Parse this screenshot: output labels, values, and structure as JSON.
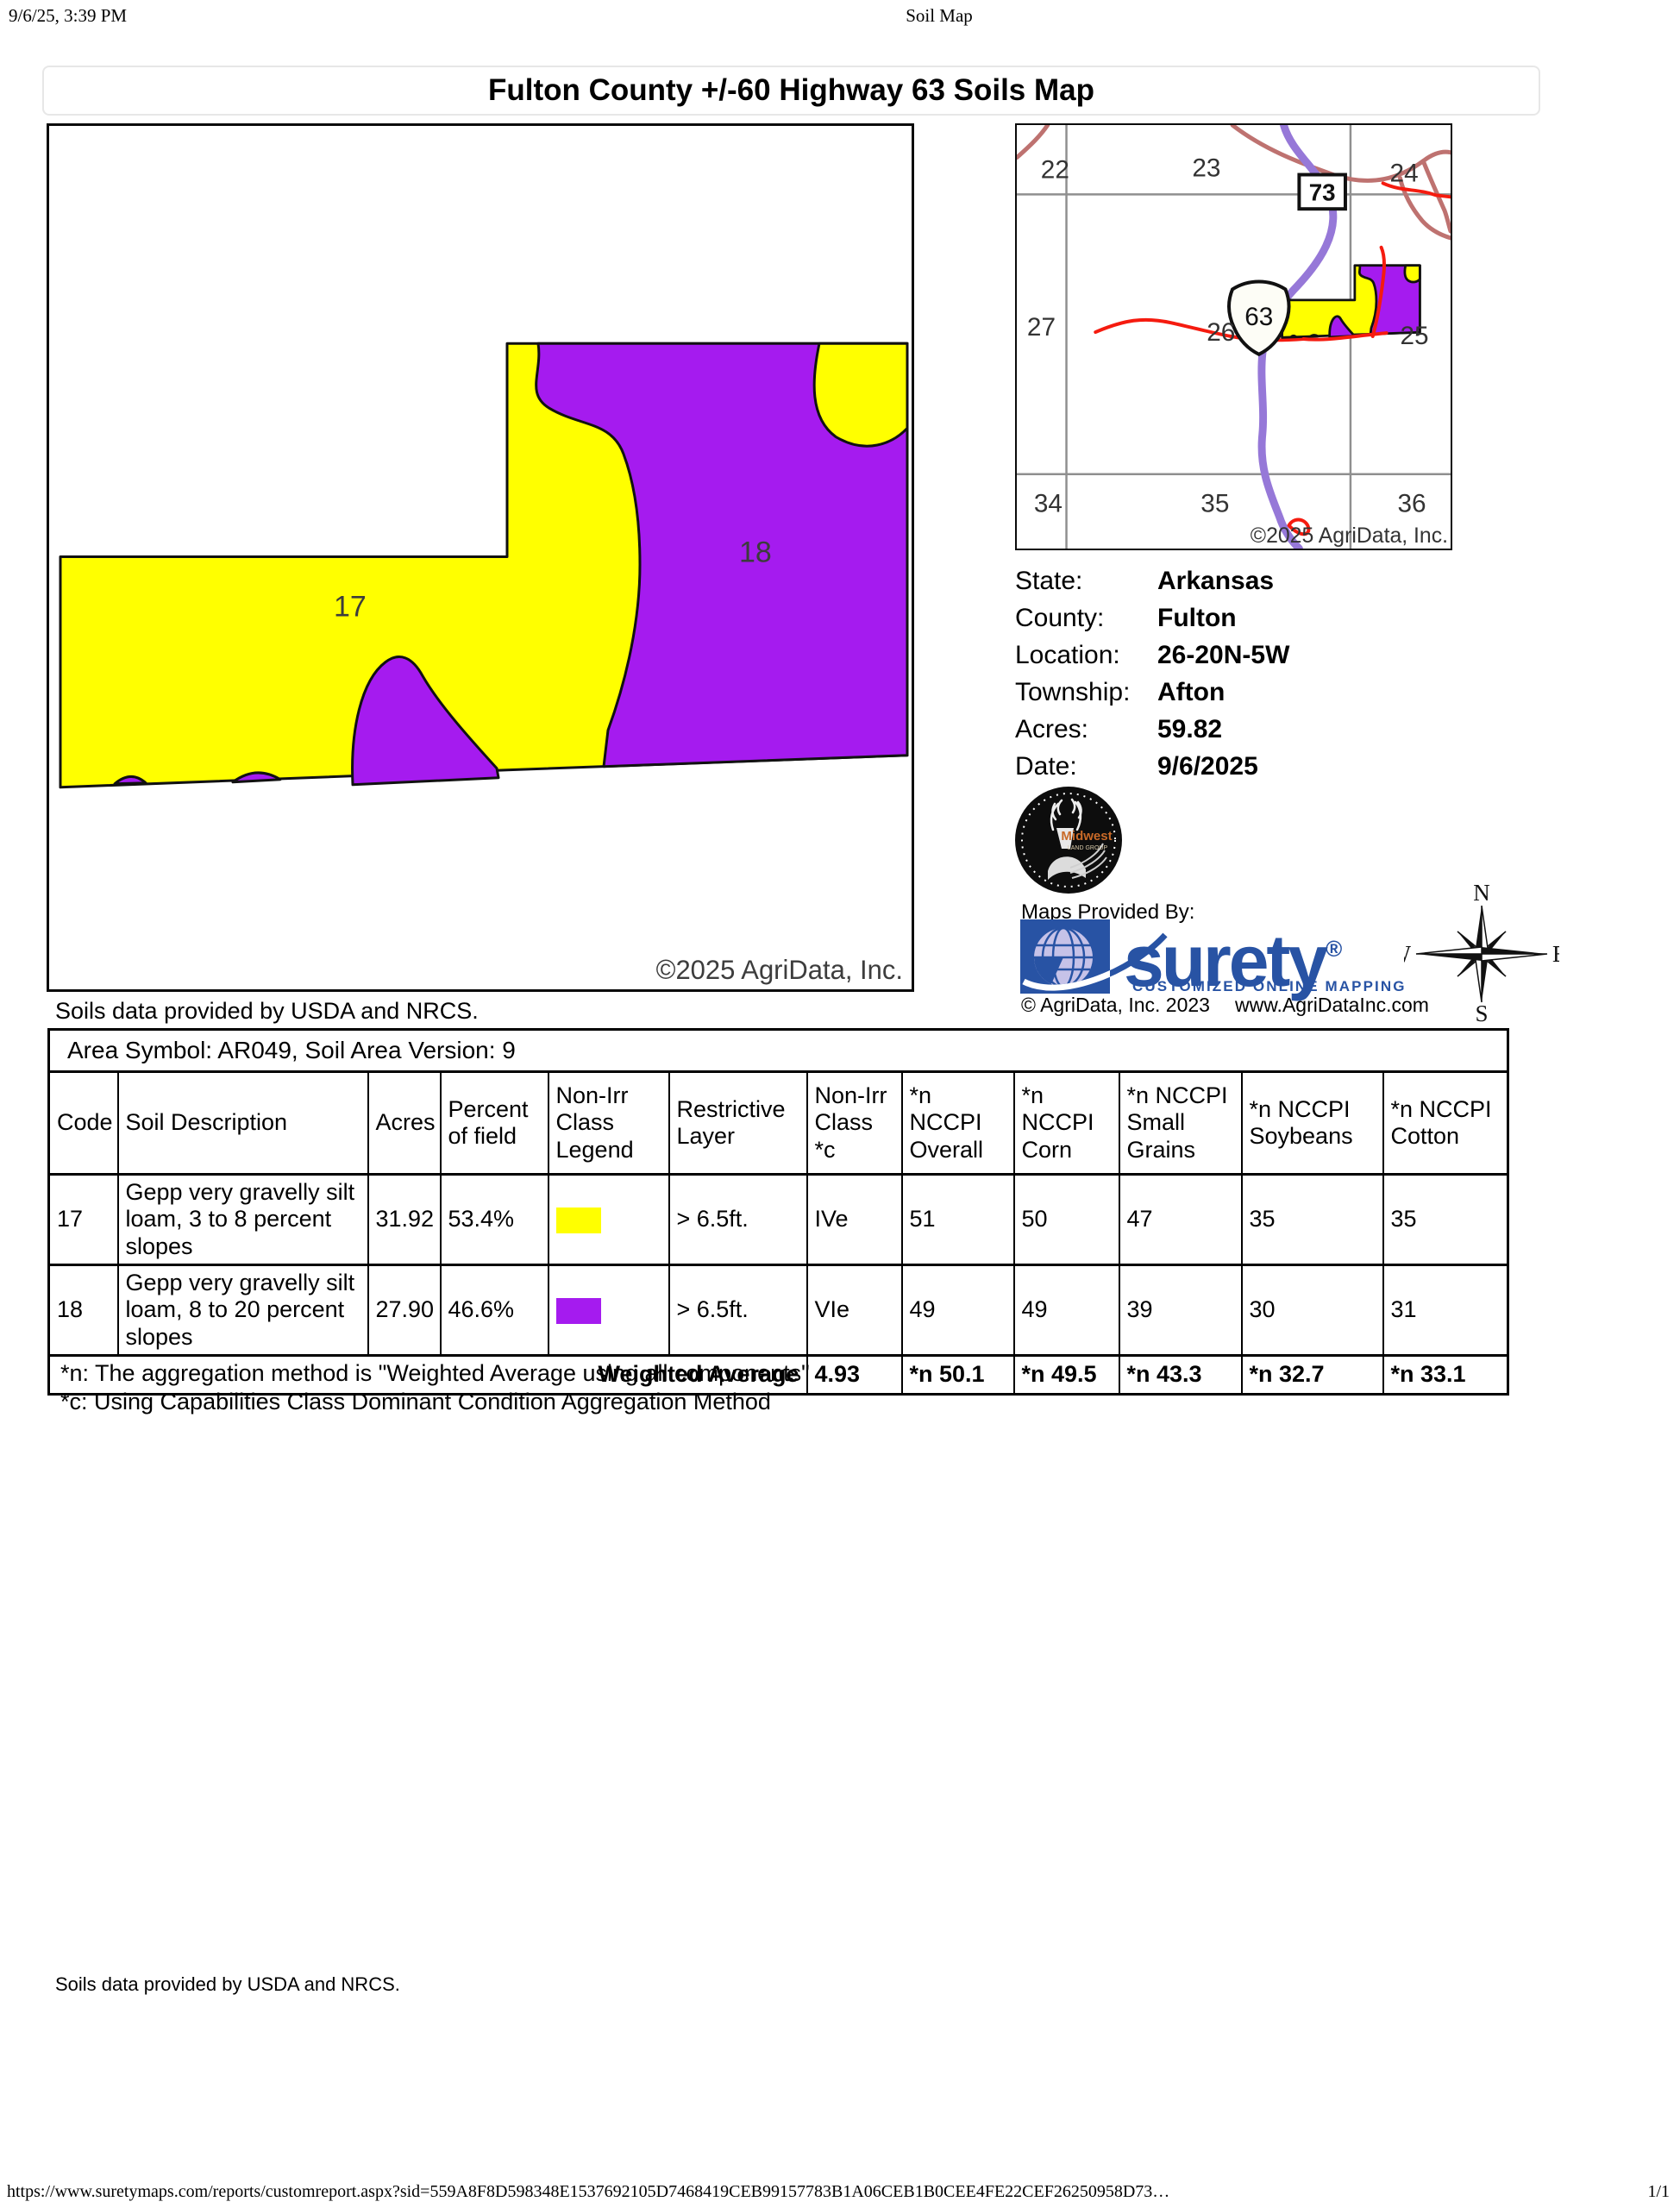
{
  "print_header": {
    "datetime": "9/6/25, 3:39 PM",
    "doc_title": "Soil Map"
  },
  "report": {
    "title": "Fulton County +/-60 Highway 63 Soils Map"
  },
  "main_map": {
    "label_17": "17",
    "label_18": "18",
    "copyright": "©2025 AgriData, Inc.",
    "soils_note": "Soils data provided by USDA and NRCS."
  },
  "inset_map": {
    "sections": [
      "22",
      "23",
      "24",
      "27",
      "26",
      "25",
      "34",
      "35",
      "36"
    ],
    "highway_badge": "73",
    "route_shield": "63",
    "copyright": "©2025 AgriData, Inc."
  },
  "location_info": {
    "rows": [
      {
        "label": "State:",
        "value": "Arkansas"
      },
      {
        "label": "County:",
        "value": "Fulton"
      },
      {
        "label": "Location:",
        "value": "26-20N-5W"
      },
      {
        "label": "Township:",
        "value": "Afton"
      },
      {
        "label": "Acres:",
        "value": "59.82"
      },
      {
        "label": "Date:",
        "value": "9/6/2025"
      }
    ]
  },
  "branding": {
    "maps_provided_by": "Maps Provided By:",
    "logo_word": "surety",
    "logo_reg": "®",
    "logo_tagline": "CUSTOMIZED ONLINE MAPPING",
    "copyright": "© AgriData, Inc. 2023",
    "website": "www.AgriDataInc.com",
    "midwest_name": "Midwest",
    "midwest_sub": "LAND GROUP",
    "compass": {
      "n": "N",
      "e": "E",
      "s": "S",
      "w": "W"
    }
  },
  "soil_table": {
    "area_symbol": "Area Symbol: AR049, Soil Area Version: 9",
    "headers": [
      "Code",
      "Soil Description",
      "Acres",
      "Percent of field",
      "Non-Irr Class Legend",
      "Restrictive Layer",
      "Non-Irr Class *c",
      "*n NCCPI Overall",
      "*n NCCPI Corn",
      "*n NCCPI Small Grains",
      "*n NCCPI Soybeans",
      "*n NCCPI Cotton"
    ],
    "rows": [
      {
        "code": "17",
        "description": "Gepp very gravelly silt loam, 3 to 8 percent slopes",
        "acres": "31.92",
        "percent": "53.4%",
        "legend_color": "soil_yellow",
        "restrictive_layer": "> 6.5ft.",
        "non_irr_class": "IVe",
        "nccpi_overall": "51",
        "nccpi_corn": "50",
        "nccpi_small_grains": "47",
        "nccpi_soybeans": "35",
        "nccpi_cotton": "35"
      },
      {
        "code": "18",
        "description": "Gepp very gravelly silt loam, 8 to 20 percent slopes",
        "acres": "27.90",
        "percent": "46.6%",
        "legend_color": "soil_purple",
        "restrictive_layer": "> 6.5ft.",
        "non_irr_class": "VIe",
        "nccpi_overall": "49",
        "nccpi_corn": "49",
        "nccpi_small_grains": "39",
        "nccpi_soybeans": "30",
        "nccpi_cotton": "31"
      }
    ],
    "weighted": {
      "label": "Weighted Average",
      "non_irr_class": "4.93",
      "nccpi_overall": "*n 50.1",
      "nccpi_corn": "*n 49.5",
      "nccpi_small_grains": "*n 43.3",
      "nccpi_soybeans": "*n 32.7",
      "nccpi_cotton": "*n 33.1"
    }
  },
  "footnotes": [
    "*n: The aggregation method is \"Weighted Average using all components\"",
    "*c: Using Capabilities Class Dominant Condition Aggregation Method"
  ],
  "bottom_note": "Soils data provided by USDA and NRCS.",
  "print_footer": {
    "url": "https://www.suretymaps.com/reports/customreport.aspx?sid=559A8F8D598348E1537692105D7468419CEB99157783B1A06CEB1B0CEE4FE22CEF26250958D73…",
    "page": "1/1"
  },
  "colors": {
    "soil_yellow": "#FFFF00",
    "soil_purple": "#A51BEF",
    "highway_purple": "#9678D8",
    "road_red": "#F51B0F",
    "road_brown": "#BE7270",
    "grid_gray": "#8f8f8f",
    "surety_blue": "#2853A4",
    "globe_lavender": "#C6C2E8",
    "midwest_orange": "#C96A28"
  }
}
